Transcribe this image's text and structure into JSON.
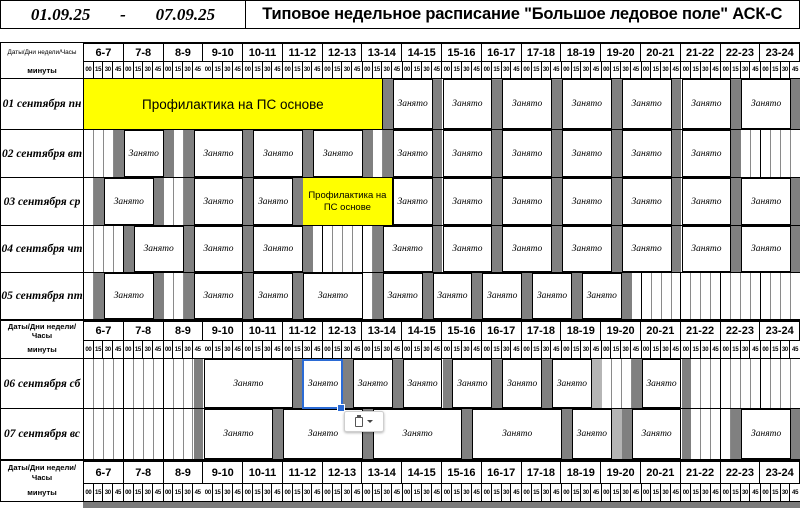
{
  "header": {
    "date_from": "01.09.25",
    "date_separator": "-",
    "date_to": "07.09.25",
    "title": "Типовое недельное расписание \"Большое ледовое поле\" АСК-С"
  },
  "axis": {
    "corner_label": "Даты/Дни недели/Часы",
    "minutes_label": "минуты",
    "hours": [
      "6-7",
      "7-8",
      "8-9",
      "9-10",
      "10-11",
      "11-12",
      "12-13",
      "13-14",
      "14-15",
      "15-16",
      "16-17",
      "17-18",
      "18-19",
      "19-20",
      "20-21",
      "21-22",
      "22-23",
      "23-24"
    ],
    "minutes": [
      "00",
      "15",
      "30",
      "45"
    ]
  },
  "labels": {
    "busy": "Занято",
    "maintenance": "Профилактика на ПС основе"
  },
  "colors": {
    "busy_fill": "#ffffff",
    "break_fill": "#808080",
    "break_light_fill": "#b5b5b5",
    "maintenance_fill": "#ffff00",
    "selection": "#2b6bd5",
    "grid_line": "#8a8a8a",
    "hour_line": "#000000"
  },
  "days": [
    {
      "label": "01 сентября пн",
      "segments": [
        {
          "type": "maint",
          "start": "06:00",
          "end": "13:30",
          "label": "Профилактика на ПС основе"
        },
        {
          "type": "break",
          "start": "13:30",
          "end": "13:45"
        },
        {
          "type": "busy",
          "start": "13:45",
          "end": "14:45",
          "label": "Занято"
        },
        {
          "type": "break",
          "start": "14:45",
          "end": "15:00"
        },
        {
          "type": "busy",
          "start": "15:00",
          "end": "16:15",
          "label": "Занято"
        },
        {
          "type": "break",
          "start": "16:15",
          "end": "16:30"
        },
        {
          "type": "busy",
          "start": "16:30",
          "end": "17:45",
          "label": "Занято"
        },
        {
          "type": "break",
          "start": "17:45",
          "end": "18:00"
        },
        {
          "type": "busy",
          "start": "18:00",
          "end": "19:15",
          "label": "Занято"
        },
        {
          "type": "break",
          "start": "19:15",
          "end": "19:30"
        },
        {
          "type": "busy",
          "start": "19:30",
          "end": "20:45",
          "label": "Занято"
        },
        {
          "type": "break",
          "start": "20:45",
          "end": "21:00"
        },
        {
          "type": "busy",
          "start": "21:00",
          "end": "22:15",
          "label": "Занято"
        },
        {
          "type": "break",
          "start": "22:15",
          "end": "22:30"
        },
        {
          "type": "busy",
          "start": "22:30",
          "end": "23:45",
          "label": "Занято"
        },
        {
          "type": "break",
          "start": "23:45",
          "end": "24:00"
        }
      ]
    },
    {
      "label": "02 сентября вт",
      "segments": [
        {
          "type": "free",
          "start": "06:00",
          "end": "06:45"
        },
        {
          "type": "break",
          "start": "06:45",
          "end": "07:00"
        },
        {
          "type": "busy",
          "start": "07:00",
          "end": "08:00",
          "label": "Занято"
        },
        {
          "type": "break",
          "start": "08:00",
          "end": "08:15"
        },
        {
          "type": "free",
          "start": "08:15",
          "end": "08:30"
        },
        {
          "type": "break",
          "start": "08:30",
          "end": "08:45"
        },
        {
          "type": "busy",
          "start": "08:45",
          "end": "10:00",
          "label": "Занято"
        },
        {
          "type": "break",
          "start": "10:00",
          "end": "10:15"
        },
        {
          "type": "busy",
          "start": "10:15",
          "end": "11:30",
          "label": "Занято"
        },
        {
          "type": "break",
          "start": "11:30",
          "end": "11:45"
        },
        {
          "type": "busy",
          "start": "11:45",
          "end": "13:00",
          "label": "Занято"
        },
        {
          "type": "break",
          "start": "13:00",
          "end": "13:15"
        },
        {
          "type": "free",
          "start": "13:15",
          "end": "13:30"
        },
        {
          "type": "break",
          "start": "13:30",
          "end": "13:45"
        },
        {
          "type": "busy",
          "start": "13:45",
          "end": "14:45",
          "label": "Занято"
        },
        {
          "type": "break",
          "start": "14:45",
          "end": "15:00"
        },
        {
          "type": "busy",
          "start": "15:00",
          "end": "16:15",
          "label": "Занято"
        },
        {
          "type": "break",
          "start": "16:15",
          "end": "16:30"
        },
        {
          "type": "busy",
          "start": "16:30",
          "end": "17:45",
          "label": "Занято"
        },
        {
          "type": "break",
          "start": "17:45",
          "end": "18:00"
        },
        {
          "type": "busy",
          "start": "18:00",
          "end": "19:15",
          "label": "Занято"
        },
        {
          "type": "break",
          "start": "19:15",
          "end": "19:30"
        },
        {
          "type": "busy",
          "start": "19:30",
          "end": "20:45",
          "label": "Занято"
        },
        {
          "type": "break",
          "start": "20:45",
          "end": "21:00"
        },
        {
          "type": "busy",
          "start": "21:00",
          "end": "22:15",
          "label": "Занято"
        },
        {
          "type": "break",
          "start": "22:15",
          "end": "22:30"
        },
        {
          "type": "free",
          "start": "22:30",
          "end": "24:00"
        }
      ]
    },
    {
      "label": "03 сентября ср",
      "segments": [
        {
          "type": "free",
          "start": "06:00",
          "end": "06:15"
        },
        {
          "type": "break",
          "start": "06:15",
          "end": "06:30"
        },
        {
          "type": "busy",
          "start": "06:30",
          "end": "07:45",
          "label": "Занято"
        },
        {
          "type": "break",
          "start": "07:45",
          "end": "08:00"
        },
        {
          "type": "free",
          "start": "08:00",
          "end": "08:30"
        },
        {
          "type": "break",
          "start": "08:30",
          "end": "08:45"
        },
        {
          "type": "busy",
          "start": "08:45",
          "end": "10:00",
          "label": "Занято"
        },
        {
          "type": "break",
          "start": "10:00",
          "end": "10:15"
        },
        {
          "type": "busy",
          "start": "10:15",
          "end": "11:15",
          "label": "Занято"
        },
        {
          "type": "break",
          "start": "11:15",
          "end": "11:30"
        },
        {
          "type": "maint",
          "start": "11:30",
          "end": "13:45",
          "label": "Профилактика на ПС основе"
        },
        {
          "type": "busy",
          "start": "13:45",
          "end": "14:45",
          "label": "Занято"
        },
        {
          "type": "break",
          "start": "14:45",
          "end": "15:00"
        },
        {
          "type": "busy",
          "start": "15:00",
          "end": "16:15",
          "label": "Занято"
        },
        {
          "type": "break",
          "start": "16:15",
          "end": "16:30"
        },
        {
          "type": "busy",
          "start": "16:30",
          "end": "17:45",
          "label": "Занято"
        },
        {
          "type": "break",
          "start": "17:45",
          "end": "18:00"
        },
        {
          "type": "busy",
          "start": "18:00",
          "end": "19:15",
          "label": "Занято"
        },
        {
          "type": "break",
          "start": "19:15",
          "end": "19:30"
        },
        {
          "type": "busy",
          "start": "19:30",
          "end": "20:45",
          "label": "Занято"
        },
        {
          "type": "break",
          "start": "20:45",
          "end": "21:00"
        },
        {
          "type": "busy",
          "start": "21:00",
          "end": "22:15",
          "label": "Занято"
        },
        {
          "type": "break",
          "start": "22:15",
          "end": "22:30"
        },
        {
          "type": "busy",
          "start": "22:30",
          "end": "23:45",
          "label": "Занято"
        },
        {
          "type": "break",
          "start": "23:45",
          "end": "24:00"
        }
      ]
    },
    {
      "label": "04 сентября чт",
      "segments": [
        {
          "type": "free",
          "start": "06:00",
          "end": "07:00"
        },
        {
          "type": "break",
          "start": "07:00",
          "end": "07:15"
        },
        {
          "type": "busy",
          "start": "07:15",
          "end": "08:30",
          "label": "Занято"
        },
        {
          "type": "break",
          "start": "08:30",
          "end": "08:45"
        },
        {
          "type": "busy",
          "start": "08:45",
          "end": "10:00",
          "label": "Занято"
        },
        {
          "type": "break",
          "start": "10:00",
          "end": "10:15"
        },
        {
          "type": "busy",
          "start": "10:15",
          "end": "11:30",
          "label": "Занято"
        },
        {
          "type": "break",
          "start": "11:30",
          "end": "11:45"
        },
        {
          "type": "free",
          "start": "11:45",
          "end": "13:15"
        },
        {
          "type": "break",
          "start": "13:15",
          "end": "13:30"
        },
        {
          "type": "busy",
          "start": "13:30",
          "end": "14:45",
          "label": "Занято"
        },
        {
          "type": "break",
          "start": "14:45",
          "end": "15:00"
        },
        {
          "type": "busy",
          "start": "15:00",
          "end": "16:15",
          "label": "Занято"
        },
        {
          "type": "break",
          "start": "16:15",
          "end": "16:30"
        },
        {
          "type": "busy",
          "start": "16:30",
          "end": "17:45",
          "label": "Занято"
        },
        {
          "type": "break",
          "start": "17:45",
          "end": "18:00"
        },
        {
          "type": "busy",
          "start": "18:00",
          "end": "19:15",
          "label": "Занято"
        },
        {
          "type": "break",
          "start": "19:15",
          "end": "19:30"
        },
        {
          "type": "busy",
          "start": "19:30",
          "end": "20:45",
          "label": "Занято"
        },
        {
          "type": "break",
          "start": "20:45",
          "end": "21:00"
        },
        {
          "type": "busy",
          "start": "21:00",
          "end": "22:15",
          "label": "Занято"
        },
        {
          "type": "break",
          "start": "22:15",
          "end": "22:30"
        },
        {
          "type": "busy",
          "start": "22:30",
          "end": "23:45",
          "label": "Занято"
        },
        {
          "type": "break",
          "start": "23:45",
          "end": "24:00"
        }
      ]
    },
    {
      "label": "05 сентября пт",
      "segments": [
        {
          "type": "free",
          "start": "06:00",
          "end": "06:15"
        },
        {
          "type": "break",
          "start": "06:15",
          "end": "06:30"
        },
        {
          "type": "busy",
          "start": "06:30",
          "end": "07:45",
          "label": "Занято"
        },
        {
          "type": "break",
          "start": "07:45",
          "end": "08:00"
        },
        {
          "type": "free",
          "start": "08:00",
          "end": "08:30"
        },
        {
          "type": "break",
          "start": "08:30",
          "end": "08:45"
        },
        {
          "type": "busy",
          "start": "08:45",
          "end": "10:00",
          "label": "Занято"
        },
        {
          "type": "break",
          "start": "10:00",
          "end": "10:15"
        },
        {
          "type": "busy",
          "start": "10:15",
          "end": "11:15",
          "label": "Занято"
        },
        {
          "type": "break",
          "start": "11:15",
          "end": "11:30"
        },
        {
          "type": "busy",
          "start": "11:30",
          "end": "13:00",
          "label": "Занято"
        },
        {
          "type": "free",
          "start": "13:00",
          "end": "13:15"
        },
        {
          "type": "break",
          "start": "13:15",
          "end": "13:30"
        },
        {
          "type": "busy",
          "start": "13:30",
          "end": "14:30",
          "label": "Занято"
        },
        {
          "type": "break",
          "start": "14:30",
          "end": "14:45"
        },
        {
          "type": "busy",
          "start": "14:45",
          "end": "15:45",
          "label": "Занято"
        },
        {
          "type": "break",
          "start": "15:45",
          "end": "16:00"
        },
        {
          "type": "busy",
          "start": "16:00",
          "end": "17:00",
          "label": "Занято"
        },
        {
          "type": "break",
          "start": "17:00",
          "end": "17:15"
        },
        {
          "type": "busy",
          "start": "17:15",
          "end": "18:15",
          "label": "Занято"
        },
        {
          "type": "break",
          "start": "18:15",
          "end": "18:30"
        },
        {
          "type": "busy",
          "start": "18:30",
          "end": "19:30",
          "label": "Занято"
        },
        {
          "type": "break",
          "start": "19:30",
          "end": "19:45"
        },
        {
          "type": "free",
          "start": "19:45",
          "end": "24:00"
        }
      ]
    },
    {
      "label": "06 сентября сб",
      "segments": [
        {
          "type": "free",
          "start": "06:00",
          "end": "08:45"
        },
        {
          "type": "break",
          "start": "08:45",
          "end": "09:00"
        },
        {
          "type": "busy",
          "start": "09:00",
          "end": "11:15",
          "label": "Занято"
        },
        {
          "type": "break",
          "start": "11:15",
          "end": "11:30"
        },
        {
          "type": "busy",
          "start": "11:30",
          "end": "12:30",
          "label": "Занято",
          "selected": true
        },
        {
          "type": "break",
          "start": "12:30",
          "end": "12:45"
        },
        {
          "type": "busy",
          "start": "12:45",
          "end": "13:45",
          "label": "Занято"
        },
        {
          "type": "break",
          "start": "13:45",
          "end": "14:00"
        },
        {
          "type": "busy",
          "start": "14:00",
          "end": "15:00",
          "label": "Занято"
        },
        {
          "type": "break",
          "start": "15:00",
          "end": "15:15"
        },
        {
          "type": "busy",
          "start": "15:15",
          "end": "16:15",
          "label": "Занято"
        },
        {
          "type": "break",
          "start": "16:15",
          "end": "16:30"
        },
        {
          "type": "busy",
          "start": "16:30",
          "end": "17:30",
          "label": "Занято"
        },
        {
          "type": "break",
          "start": "17:30",
          "end": "17:45"
        },
        {
          "type": "busy",
          "start": "17:45",
          "end": "18:45",
          "label": "Занято"
        },
        {
          "type": "break_light",
          "start": "18:45",
          "end": "19:00"
        },
        {
          "type": "free",
          "start": "19:00",
          "end": "19:45"
        },
        {
          "type": "break",
          "start": "19:45",
          "end": "20:00"
        },
        {
          "type": "busy",
          "start": "20:00",
          "end": "21:00",
          "label": "Занято"
        },
        {
          "type": "break",
          "start": "21:00",
          "end": "21:15"
        },
        {
          "type": "free",
          "start": "21:15",
          "end": "24:00"
        }
      ]
    },
    {
      "label": "07 сентября вс",
      "segments": [
        {
          "type": "free",
          "start": "06:00",
          "end": "08:45"
        },
        {
          "type": "break",
          "start": "08:45",
          "end": "09:00"
        },
        {
          "type": "busy",
          "start": "09:00",
          "end": "10:45",
          "label": "Занято"
        },
        {
          "type": "break",
          "start": "10:45",
          "end": "11:00"
        },
        {
          "type": "busy",
          "start": "11:00",
          "end": "13:00",
          "label": "Занято"
        },
        {
          "type": "break",
          "start": "13:00",
          "end": "13:15"
        },
        {
          "type": "busy",
          "start": "13:15",
          "end": "15:30",
          "label": "Занято"
        },
        {
          "type": "break",
          "start": "15:30",
          "end": "15:45"
        },
        {
          "type": "busy",
          "start": "15:45",
          "end": "18:00",
          "label": "Занято"
        },
        {
          "type": "break",
          "start": "18:00",
          "end": "18:15"
        },
        {
          "type": "busy",
          "start": "18:15",
          "end": "19:15",
          "label": "Занято"
        },
        {
          "type": "break_light",
          "start": "19:15",
          "end": "19:30"
        },
        {
          "type": "break",
          "start": "19:30",
          "end": "19:45"
        },
        {
          "type": "busy",
          "start": "19:45",
          "end": "21:00",
          "label": "Занято"
        },
        {
          "type": "break",
          "start": "21:00",
          "end": "21:15"
        },
        {
          "type": "free",
          "start": "21:15",
          "end": "22:15"
        },
        {
          "type": "break",
          "start": "22:15",
          "end": "22:30"
        },
        {
          "type": "busy",
          "start": "22:30",
          "end": "23:45",
          "label": "Занято"
        },
        {
          "type": "break",
          "start": "23:45",
          "end": "24:00"
        }
      ]
    }
  ],
  "selection": {
    "day_label": "06 сентября сб",
    "start": "11:30",
    "end": "12:30"
  },
  "icons": {
    "paste_clipboard": "clipboard-icon",
    "paste_caret": "▾",
    "fill_handle": "fill-handle"
  }
}
